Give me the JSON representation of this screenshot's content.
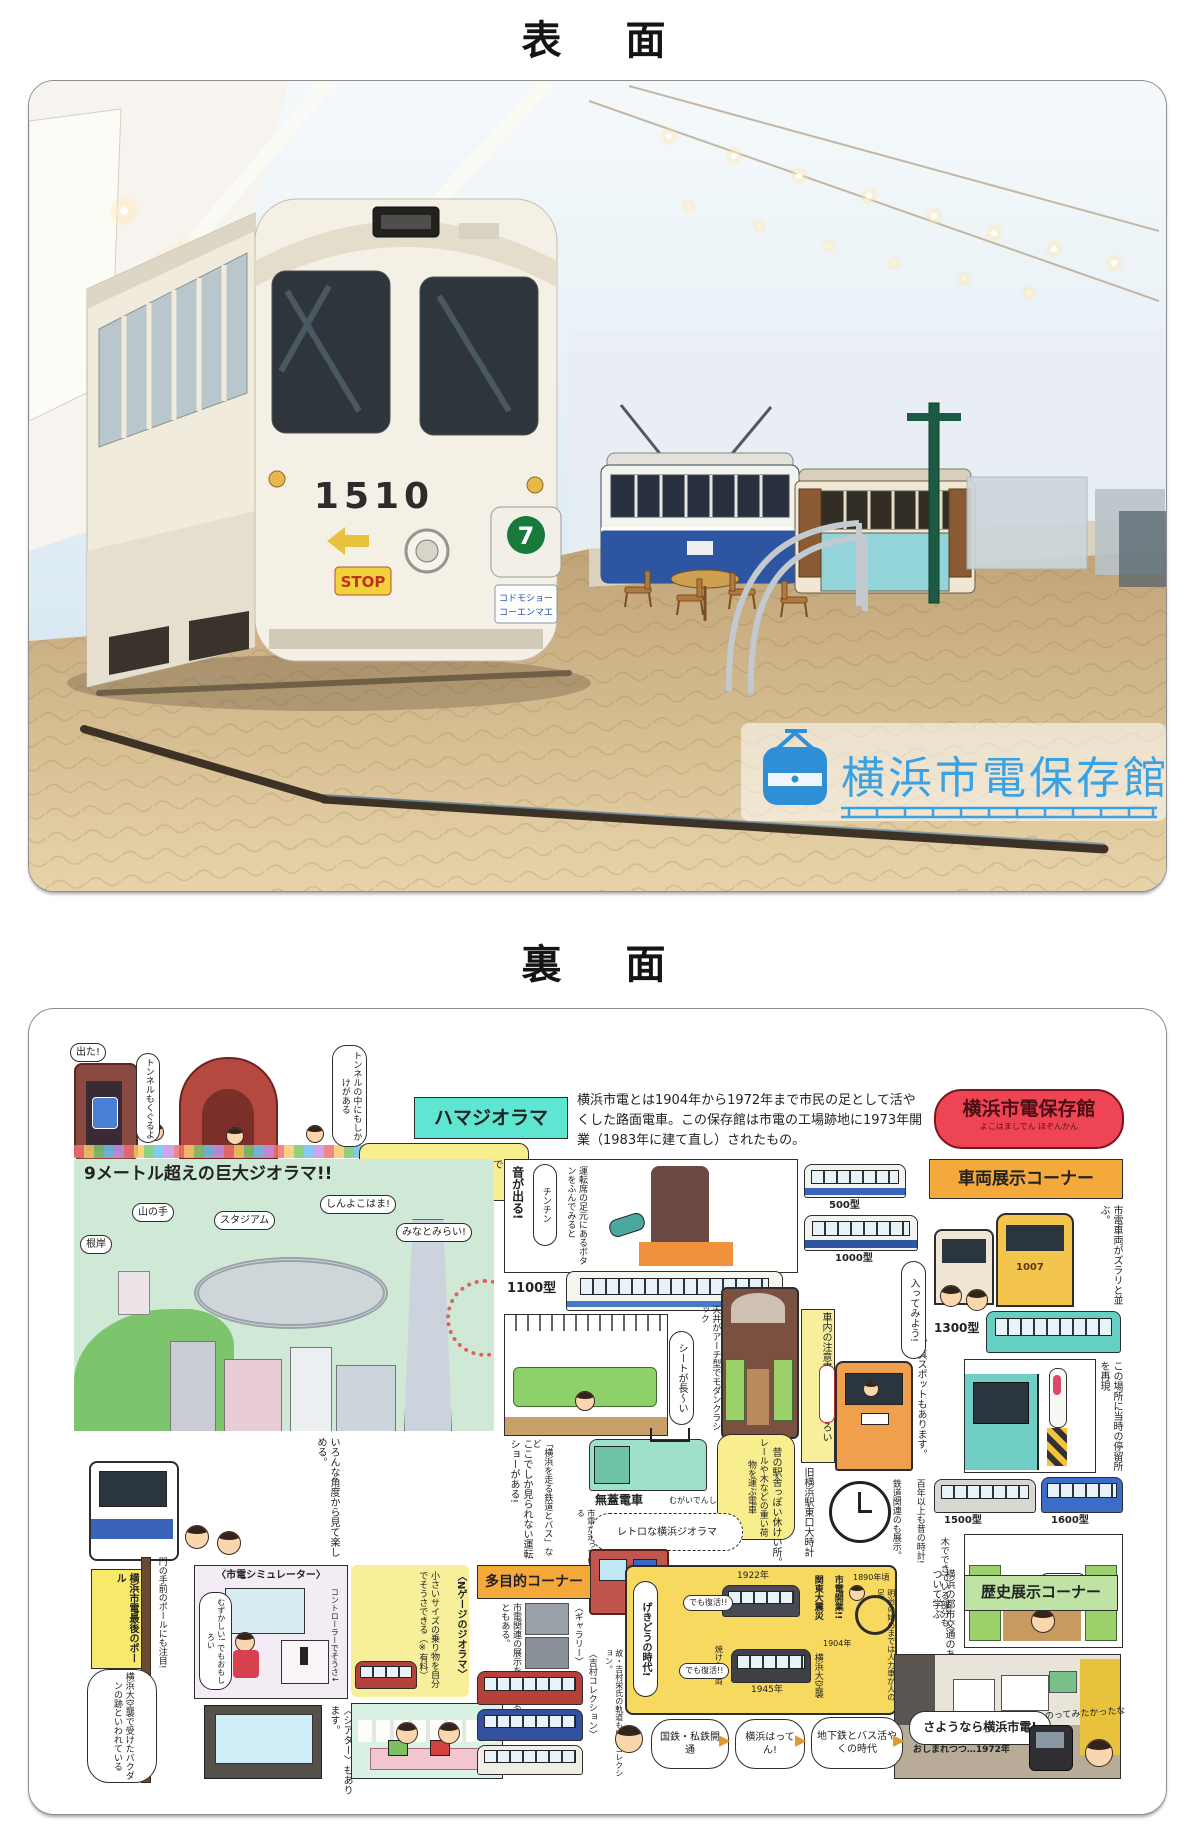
{
  "front": {
    "title": "表　面",
    "tram": {
      "number": "1510",
      "route": "7",
      "stop": "STOP",
      "dest_line1": "コドモショー",
      "dest_line2": "コーエンマエ"
    },
    "logo_text": "横浜市電保存館"
  },
  "back": {
    "title": "裏　面",
    "intro": "横浜市電とは1904年から1972年まで市民の足として活やくした路面電車。この保存館は市電の工場跡地に1973年開業（1983年に建て直し）されたもの。",
    "badge": {
      "title": "横浜市電保存館",
      "kana": "よこはましでん ほぞんかん"
    },
    "tunnel": {
      "b1": "トンネルもくぐるよ",
      "b2": "出た!",
      "b3": "トンネルの中にもしかけがある"
    },
    "hama": "ハマジオラマ",
    "entrance": "入口から線路にそって進んでいく。",
    "diorama": {
      "title": "9メートル超えの巨大ジオラマ!!",
      "negishi": "根岸",
      "yamanote": "山の手",
      "stadium": "スタジアム",
      "shinyoko": "しんよこはま!",
      "minatomirai": "みなとみらい!",
      "caption": "いろんな角度から見て楽しめる。"
    },
    "sound": {
      "oto": "音が出る!",
      "chin": "チンチン",
      "button": "運転席の足元にあるボタンをふんでみると"
    },
    "types": {
      "t500": "500型",
      "t1000": "1000型",
      "t1100": "1100型",
      "t1300": "1300型",
      "t1500": "1500型",
      "t1600": "1600型",
      "car1007": "1007"
    },
    "notes": {
      "seat": "シートが長〜い",
      "arch": "天井がアーチ型でモダンクラシック",
      "lineup": "市電車両がズラリと並ぶ。",
      "enter": "入ってみよう!",
      "notice": "車内の注意書きもおもしろい",
      "stop": "この場所に当時の停留所を再現",
      "wood": "木でできている部分も",
      "sukkiri": "すっきり",
      "show1": "ここでしか見られない運転ショーがある!",
      "show2": "「横浜を走る鉄道とバス」など",
      "mugai": "無蓋電車",
      "mugai_kana": "むがいでんしゃ",
      "mugai_note": "レールや木などの重い荷物を運ぶ電車",
      "retro": "レトロな横浜ジオラマ",
      "hashiru": "市電が走っている",
      "rest": "昔の駅舎っぽい休けい所。",
      "photospot": "写真スポットもあります。",
      "clock": "旧横浜駅東口大時計",
      "tetsudo": "鉄道関連のも展示。",
      "hyakunen": "百年以上も昔の時計!"
    },
    "corners": {
      "vehicles": "車両展示コーナー",
      "multi": "多目的コーナー",
      "history": "歴史展示コーナー"
    },
    "pole": {
      "box": "横浜市電最後のポール",
      "note": "門の手前のポールにも注目!",
      "bomb": "横浜大空襲で受けたバクダンの跡といわれている"
    },
    "sim": {
      "title": "〈市電シミュレーター〉",
      "hard": "むずかしい! でもおもしろい",
      "controller": "コントローラーでそうさ↓",
      "theater": "〈シアター〉もあります。"
    },
    "ngauge": {
      "title": "〈Nゲージのジオラマ〉",
      "note": "小さいサイズの乗り物を自分でそうさできる（※有料）"
    },
    "multi": {
      "note": "市電関連の展示をしていることもある。",
      "gallery": "〈ギャラリー〉",
      "yoshimura": "〈吉村コレクション〉",
      "yoshimura_note": "故・吉村栄氏の軌道もけいコレクション。"
    },
    "history_note": "横浜の都市交通のあゆみについて学ぶ",
    "gekido": {
      "title": "げきどうの時代!",
      "open": "市電開業!!",
      "y1904": "1904年",
      "shinsai": "関東大震災",
      "y1922": "1922年",
      "fukkatsu": "でも復活!!",
      "kushu": "横浜大空襲",
      "y1945": "1945年",
      "yaketa": "焼けた車両",
      "meiji": "明治の始めまでは人力車が人の足",
      "y1890": "1890年頃"
    },
    "timeline": {
      "a": "国鉄・私鉄開通",
      "b": "横浜はってん!",
      "c": "地下鉄とバス活やくの時代",
      "d": "さようなら横浜市電!",
      "e": "おしまれつつ…1972年",
      "ride": "のってみたかったな"
    }
  }
}
